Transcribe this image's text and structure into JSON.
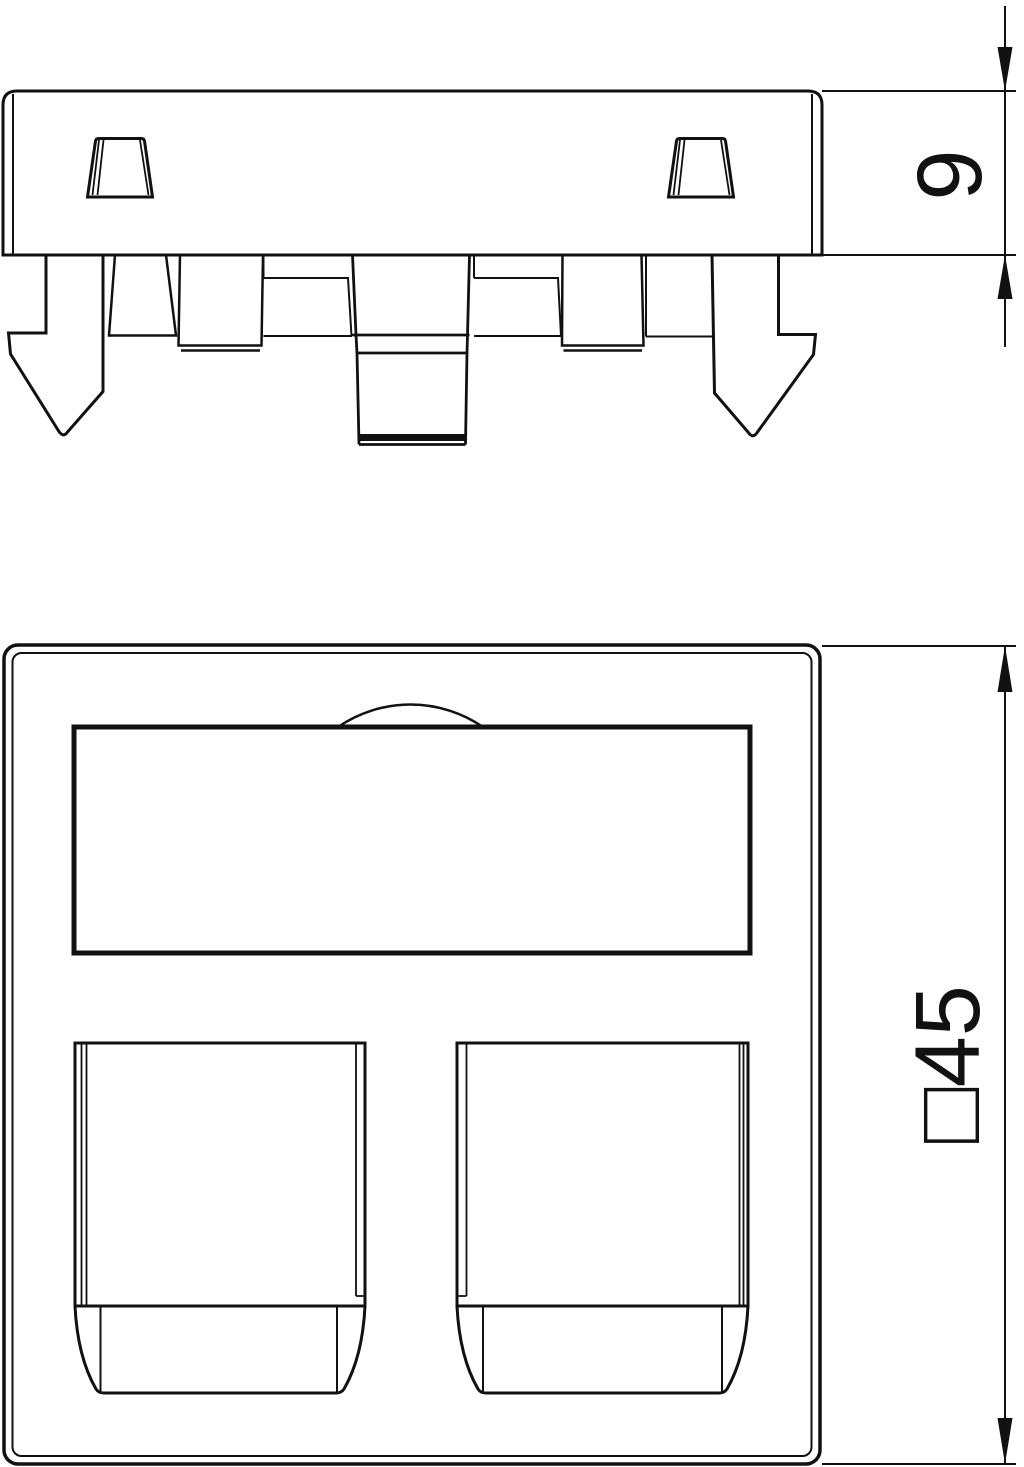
{
  "colors": {
    "line": "#111111",
    "background": "#ffffff"
  },
  "dimensions": {
    "side_height": {
      "label": "9"
    },
    "front_size": {
      "label": "□45"
    }
  }
}
